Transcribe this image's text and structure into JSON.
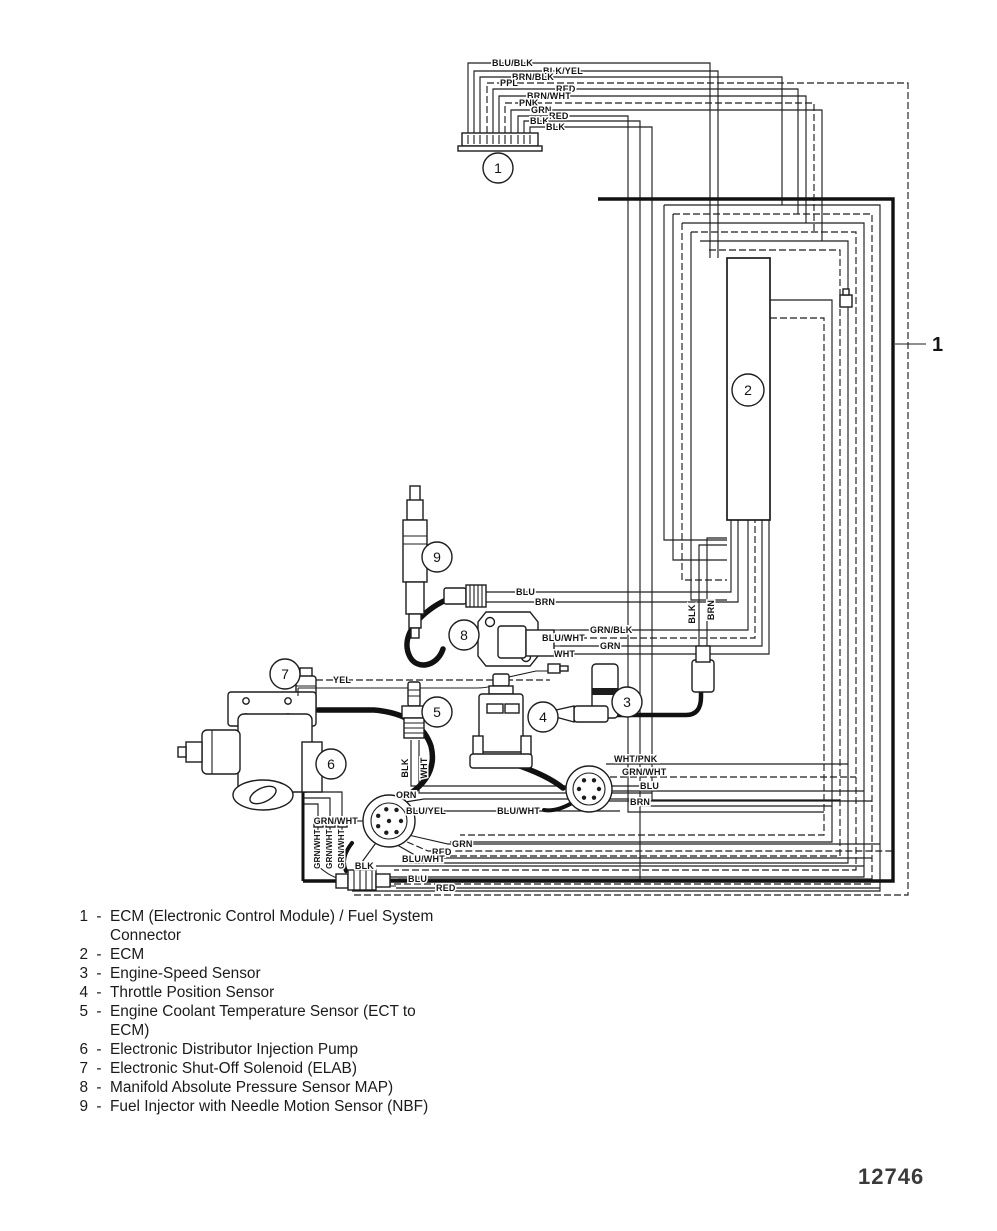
{
  "figure": {
    "number": "12746",
    "right_callout_label": "1"
  },
  "callouts": [
    "1",
    "2",
    "3",
    "4",
    "5",
    "6",
    "7",
    "8",
    "9"
  ],
  "wire_labels": {
    "top_connector": [
      "BLU/BLK",
      "BLK/YEL",
      "BRN/BLK",
      "PPL",
      "RED",
      "BRN/WHT",
      "PNK",
      "GRN",
      "RED",
      "BLK",
      "BLK"
    ],
    "injector_nbf": [
      "BLU",
      "BRN"
    ],
    "map_sensor": [
      "BLU/WHT",
      "GRN/BLK",
      "GRN",
      "WHT"
    ],
    "elab_solenoid": [
      "YEL"
    ],
    "ect_sensor": [
      "BLK",
      "WHT"
    ],
    "speed_sensor": [
      "BLK",
      "BRN"
    ],
    "engine_connector": [
      "WHT/PNK",
      "GRN/WHT",
      "BLU",
      "BRN",
      "BLU/WHT"
    ],
    "pump_connector": [
      "ORN",
      "BLU/YEL",
      "GRN/WHT",
      "GRN",
      "RED",
      "BLU/WHT",
      "BLK"
    ],
    "pump_pigtails": [
      "GRN/WHT",
      "GRN/WHT",
      "GRN/WHT"
    ],
    "power_connector": [
      "BLU",
      "RED"
    ]
  },
  "legend": {
    "separator": "-",
    "items": [
      {
        "num": "1",
        "lines": [
          "ECM (Electronic Control Module) / Fuel System",
          "Connector"
        ]
      },
      {
        "num": "2",
        "lines": [
          "ECM"
        ]
      },
      {
        "num": "3",
        "lines": [
          "Engine-Speed Sensor"
        ]
      },
      {
        "num": "4",
        "lines": [
          "Throttle Position Sensor"
        ]
      },
      {
        "num": "5",
        "lines": [
          "Engine Coolant Temperature Sensor (ECT to",
          "ECM)"
        ]
      },
      {
        "num": "6",
        "lines": [
          "Electronic Distributor Injection Pump"
        ]
      },
      {
        "num": "7",
        "lines": [
          "Electronic Shut-Off Solenoid (ELAB)"
        ]
      },
      {
        "num": "8",
        "lines": [
          "Manifold Absolute Pressure Sensor MAP)"
        ]
      },
      {
        "num": "9",
        "lines": [
          "Fuel Injector with Needle Motion Sensor (NBF)"
        ]
      }
    ]
  }
}
